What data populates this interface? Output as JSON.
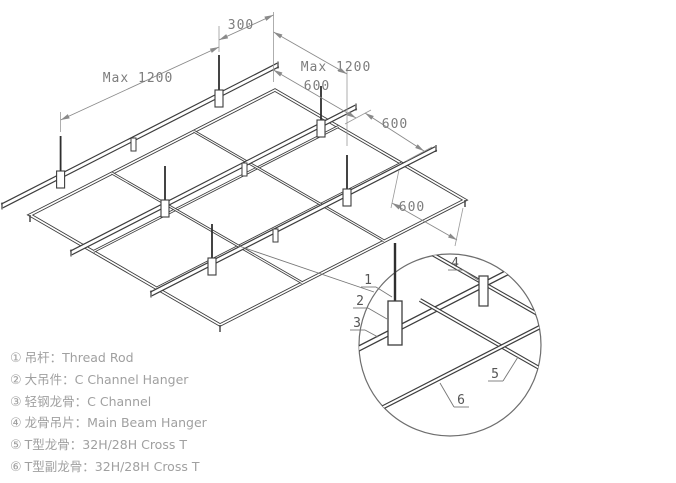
{
  "diagram": {
    "dimensions": {
      "rod_offset": "300",
      "hanger_spacing": "Max 1200",
      "channel_spacing": "Max 1200",
      "tee_spacing_1": "600",
      "tee_spacing_2": "600",
      "tee_spacing_3": "600"
    },
    "detail_callouts": [
      "1",
      "2",
      "3",
      "4",
      "5",
      "6"
    ]
  },
  "legend": {
    "items": [
      {
        "marker": "①",
        "text": "吊杆：Thread Rod"
      },
      {
        "marker": "②",
        "text": "大吊件：C Channel Hanger"
      },
      {
        "marker": "③",
        "text": "轻钢龙骨：C Channel"
      },
      {
        "marker": "④",
        "text": "龙骨吊片：Main Beam Hanger"
      },
      {
        "marker": "⑤",
        "text": "T型龙骨：32H/28H Cross T"
      },
      {
        "marker": "⑥",
        "text": "T型副龙骨：32H/28H Cross T"
      }
    ]
  }
}
